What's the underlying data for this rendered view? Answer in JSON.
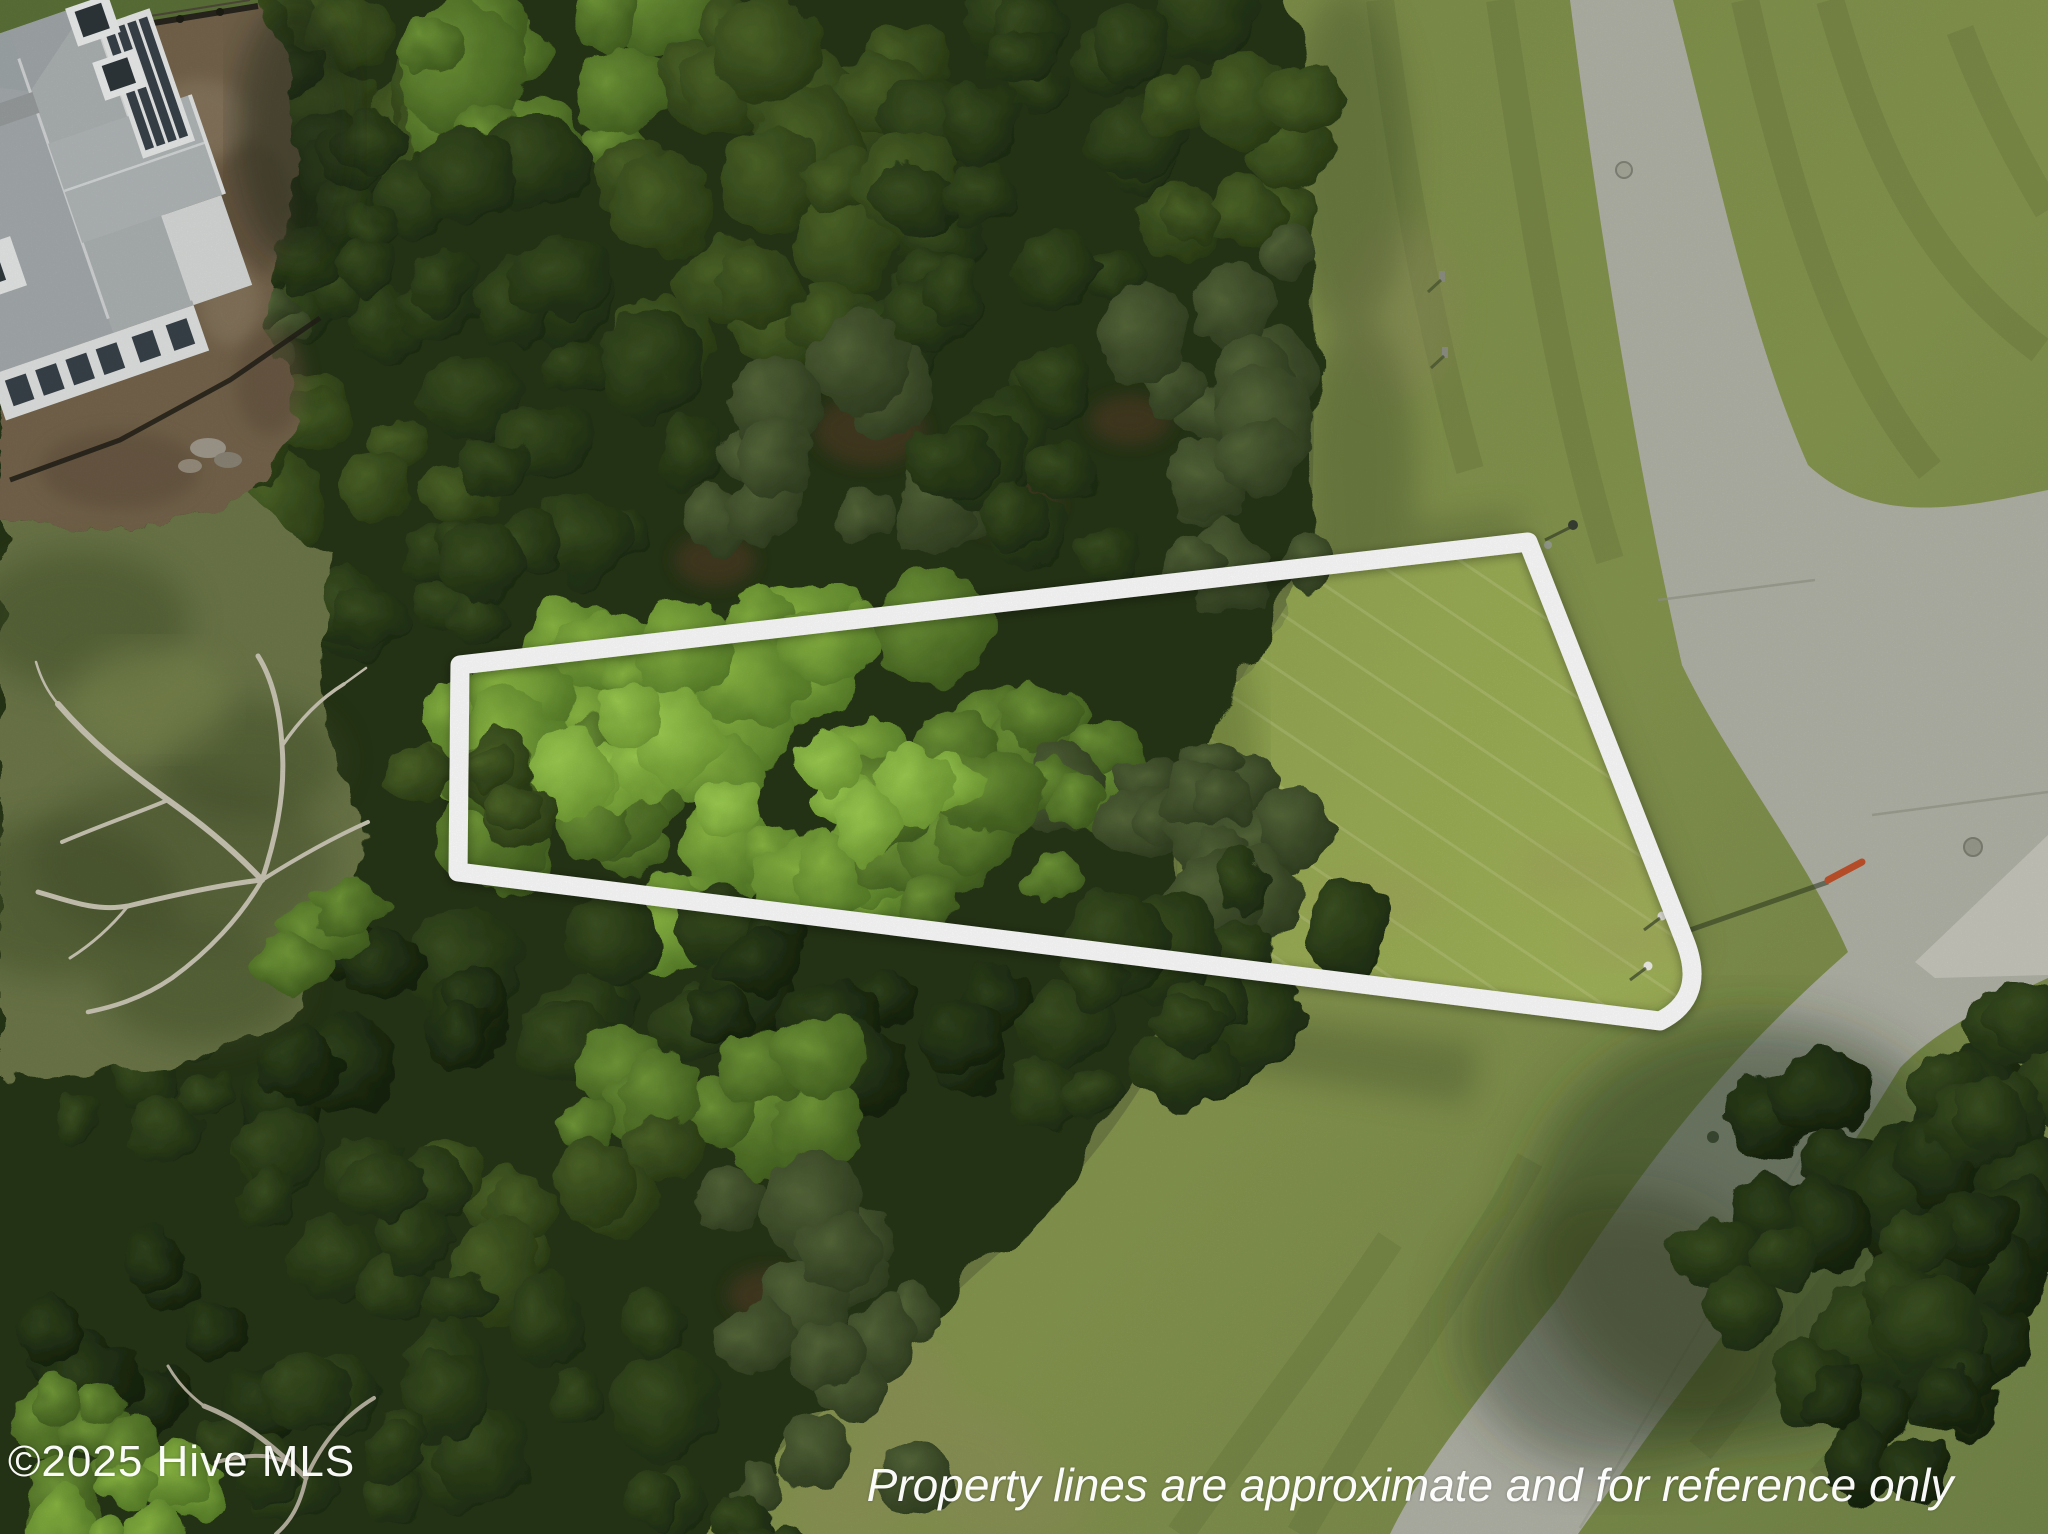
{
  "watermark": {
    "text": "©2025 Hive MLS",
    "color": "#ffffff"
  },
  "disclaimer": {
    "text": "Property lines are approximate and for reference only",
    "color": "#ffffff"
  },
  "property_outline": {
    "color": "#ffffff",
    "stroke_width": 19,
    "svg_path": "M 460,665 L 1528,542 L 1686,944 Q 1706,998 1660,1021 L 458,872 Z"
  },
  "palette": {
    "canopy_dark": "#1c2b10",
    "canopy_bright": "#8cb944",
    "lawn": "#87974f",
    "lawn_sunlit": "#9cb055",
    "road_asphalt": "#b3b4a8",
    "dirt": "#76654d",
    "house_roof": "#b6babc",
    "outline_white": "#ffffff"
  }
}
